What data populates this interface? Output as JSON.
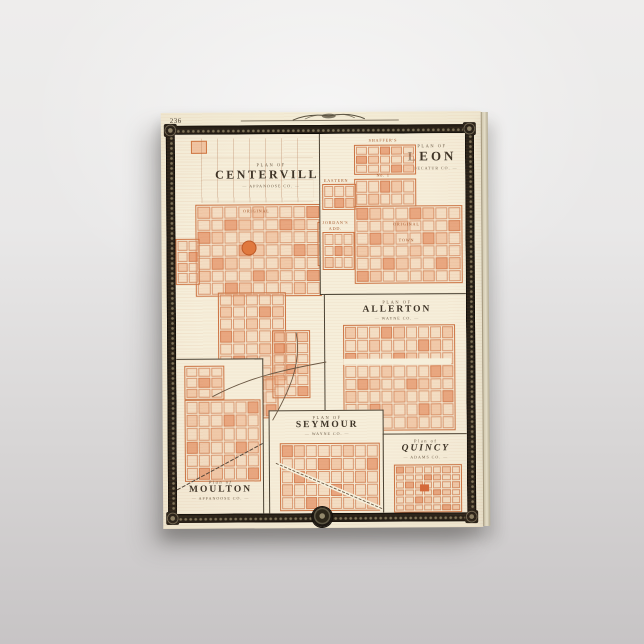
{
  "colors": {
    "paper": "#f3ecd6",
    "plat_orange": "#d97b4a",
    "ink": "#3b3226",
    "frame": "#241e16",
    "backdrop_top": "#eeedec",
    "backdrop_bottom": "#c7c4c5"
  },
  "map": {
    "page_number": "236",
    "panels": {
      "centerville": {
        "plan_of": "PLAN OF",
        "name": "CENTERVILLE",
        "county": "APPANOOSE CO.",
        "district_label": "ORIGINAL"
      },
      "leon": {
        "plan_of": "PLAN OF",
        "name": "LEON",
        "county": "DECATUR CO.",
        "additions": [
          "SHAFFER'S",
          "No. 1",
          "EASTERN",
          "JORDAN'S",
          "ADD.",
          "ORIGINAL",
          "TOWN"
        ]
      },
      "allerton": {
        "plan_of": "PLAN OF",
        "name": "ALLERTON",
        "county": "WAYNE CO."
      },
      "moulton": {
        "plan_of": "Plan of",
        "name": "MOULTON",
        "county": "APPANOOSE CO."
      },
      "seymour": {
        "plan_of": "PLAN OF",
        "name": "SEYMOUR",
        "county": "WAYNE CO."
      },
      "quincy": {
        "plan_of": "Plan of",
        "name": "QUINCY",
        "county": "ADAMS CO."
      }
    }
  }
}
